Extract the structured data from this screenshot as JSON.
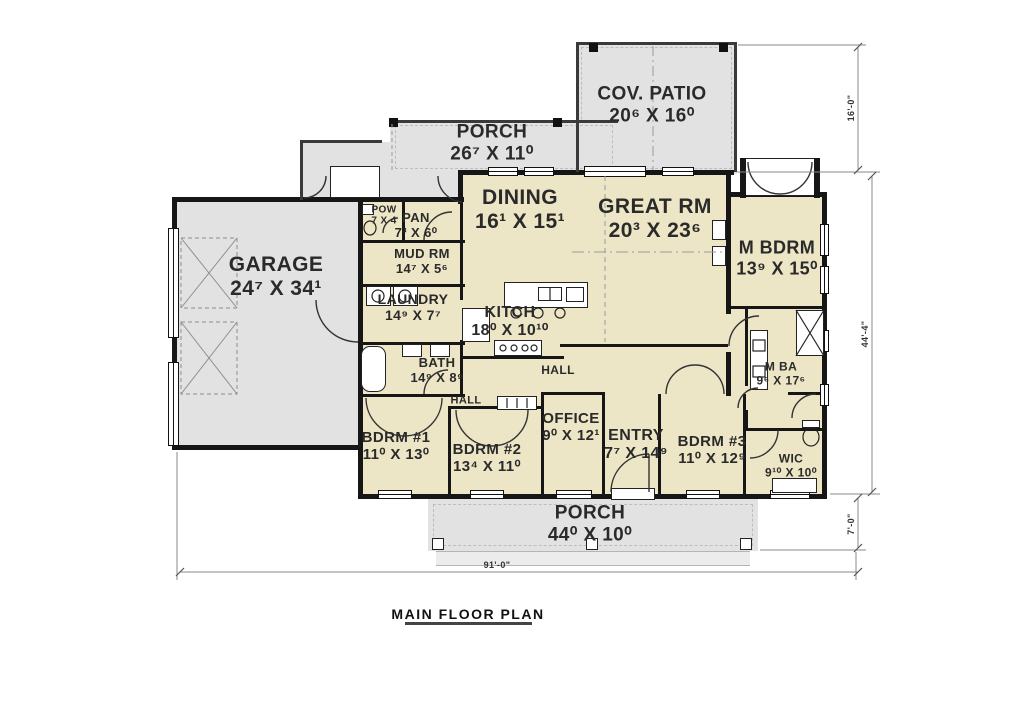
{
  "title": "MAIN FLOOR PLAN",
  "rooms": [
    {
      "name": "COV. PATIO",
      "dims": "20⁶ X 16⁰"
    },
    {
      "name": "PORCH",
      "dims": "26⁷ X 11⁰"
    },
    {
      "name": "GARAGE",
      "dims": "24⁷ X 34¹"
    },
    {
      "name": "DINING",
      "dims": "16¹ X 15¹"
    },
    {
      "name": "GREAT RM",
      "dims": "20³ X 23⁶"
    },
    {
      "name": "M BDRM",
      "dims": "13⁹ X 15⁰"
    },
    {
      "name": "POW",
      "dims": "7 X 4"
    },
    {
      "name": "PAN",
      "dims": "7³ X 6⁰"
    },
    {
      "name": "MUD RM",
      "dims": "14⁷ X 5⁶"
    },
    {
      "name": "LAUNDRY",
      "dims": "14⁹ X 7⁷"
    },
    {
      "name": "KITCH",
      "dims": "18⁰ X 10¹⁰"
    },
    {
      "name": "BATH",
      "dims": "14⁹ X 8⁹"
    },
    {
      "name": "HALL",
      "dims": ""
    },
    {
      "name": "HALL",
      "dims": ""
    },
    {
      "name": "BDRM #1",
      "dims": "11⁰ X 13⁰"
    },
    {
      "name": "BDRM #2",
      "dims": "13⁴ X 11⁰"
    },
    {
      "name": "OFFICE",
      "dims": "9⁰ X 12¹"
    },
    {
      "name": "ENTRY",
      "dims": "7⁷ X 14⁹"
    },
    {
      "name": "BDRM #3",
      "dims": "11⁰ X 12⁹"
    },
    {
      "name": "M BA",
      "dims": "9⁶ X 17⁶"
    },
    {
      "name": "WIC",
      "dims": "9¹⁰ X 10⁰"
    },
    {
      "name": "PORCH",
      "dims": "44⁰ X 10⁰"
    }
  ],
  "dimensions": {
    "patio_height": "16'-0\"",
    "main_height": "44'-4\"",
    "porch_depth": "7'-0\"",
    "overall_width": "91'-0\""
  },
  "colors": {
    "wall": "#161616",
    "interior_fill": "#ece6c6",
    "exterior_fill": "#e2e2e2",
    "label_text": "#2a2a2a"
  }
}
